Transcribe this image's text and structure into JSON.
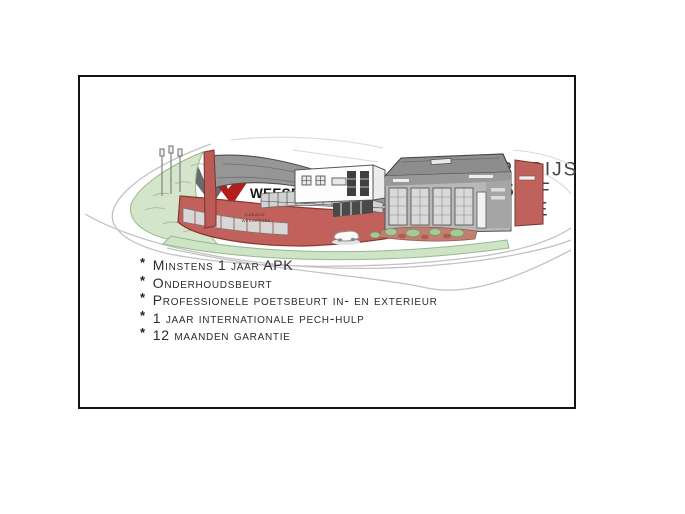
{
  "logo": {
    "company_small": "GARAGE",
    "company_name": "WEESEPOEL BV",
    "mark_gray": "#6a6a6a",
    "mark_red": "#b01e1e"
  },
  "header": {
    "title_line1": "RIJKLAARPRIJS",
    "title_line2": "INCLUSIEF GARANTIE"
  },
  "illustration": {
    "building_label_line1": "GARAGE",
    "building_label_line2": "WEESEPOEL",
    "facade_red": "#c2605b",
    "roof_gray": "#969696",
    "grass_green": "#cfe3c6"
  },
  "benefits": {
    "bullet": "*",
    "items": [
      "Minstens 1 jaar APK",
      "Onderhoudsbeurt",
      "Professionele poetsbeurt in- en exterieur",
      "1 jaar internationale pech-hulp",
      "12 maanden garantie"
    ]
  }
}
